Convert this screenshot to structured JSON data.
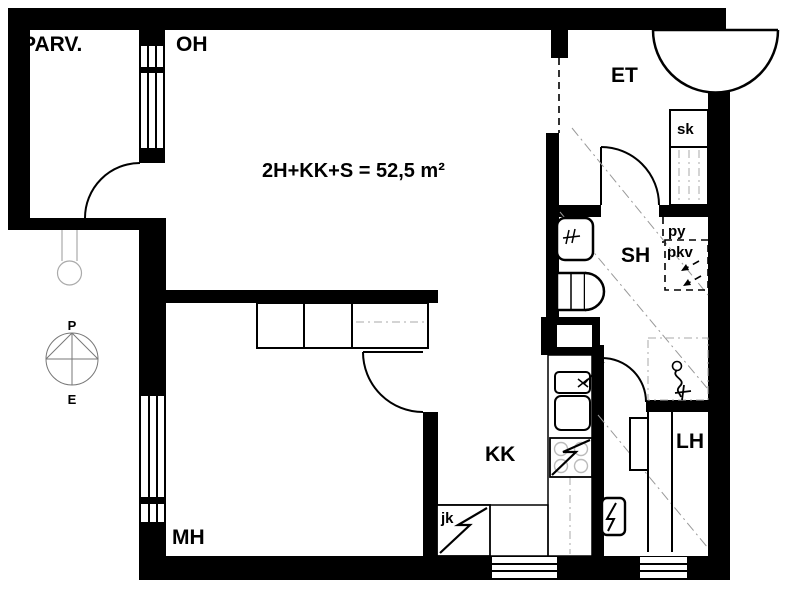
{
  "plan": {
    "area_text": "2H+KK+S = 52,5 m²",
    "rooms": {
      "balcony": "PARV.",
      "living_room": "OH",
      "entrance": "ET",
      "shower_room": "SH",
      "sauna": "LH",
      "kitchenette": "KK",
      "bedroom": "MH"
    },
    "storage": {
      "closet": "sk",
      "laundry_space": "py",
      "drying_cabinet": "pkv"
    },
    "appliances": {
      "fridge": "jk"
    },
    "compass": {
      "north": "P",
      "south": "E"
    },
    "colors": {
      "wall": "#000000",
      "background": "#ffffff",
      "guide_line": "#999999",
      "compass_line": "#777777"
    }
  }
}
